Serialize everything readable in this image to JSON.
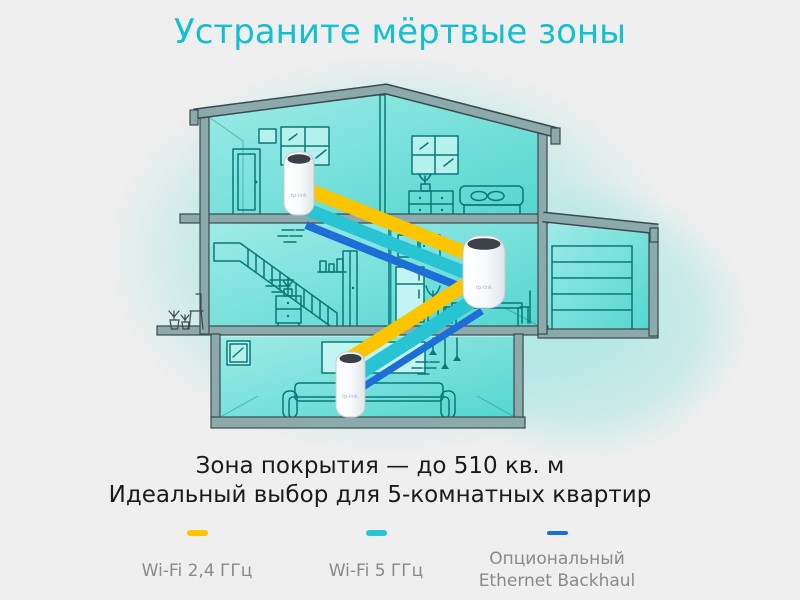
{
  "colors": {
    "accent": "#14BFCF",
    "wifi24": "#FDC400",
    "wifi5": "#29C4D4",
    "ethernet": "#1E6ED8",
    "text_dark": "#1B1B1B",
    "text_gray": "#8A8A8A",
    "bg": "#EFEFEF"
  },
  "title": {
    "text": "Устраните мёртвые зоны"
  },
  "coverage": {
    "line1": "Зона покрытия — до 510 кв. м",
    "line2": "Идеальный выбор для 5-комнатных квартир"
  },
  "legend": {
    "items": [
      {
        "id": "wifi-2-4-ghz",
        "label": "Wi-Fi 2,4 ГГц"
      },
      {
        "id": "wifi-5-ghz",
        "label": "Wi-Fi 5 ГГц"
      },
      {
        "id": "ethernet-backhaul",
        "label": "Опциональный Ethernet Backhaul"
      }
    ]
  },
  "diagram": {
    "device_brand": "tp-link",
    "device_count": 3
  }
}
